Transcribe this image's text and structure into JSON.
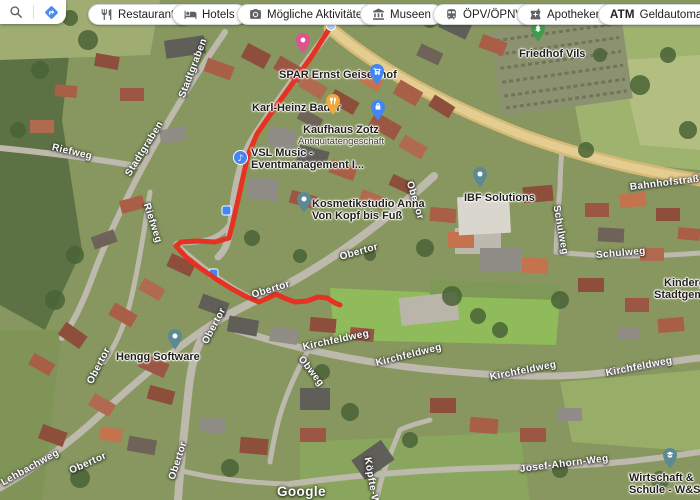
{
  "toolbar": {
    "buttons": [
      {
        "label": "Restaurants"
      },
      {
        "label": "Hotels"
      },
      {
        "label": "Mögliche Aktivitäten"
      },
      {
        "label": "Museen"
      },
      {
        "label": "ÖPV/ÖPNV"
      },
      {
        "label": "Apotheken"
      },
      {
        "label": "Geldautomaten"
      }
    ],
    "atm_icon_text": "ATM"
  },
  "map": {
    "watermark": "Google",
    "route": {
      "color": "#e63222",
      "start_dot_color": "#a6d3f2",
      "points": [
        [
          331,
          26
        ],
        [
          312,
          56
        ],
        [
          292,
          84
        ],
        [
          272,
          112
        ],
        [
          257,
          134
        ],
        [
          248,
          155
        ],
        [
          243,
          177
        ],
        [
          238,
          200
        ],
        [
          233,
          222
        ],
        [
          229,
          238
        ],
        [
          215,
          242
        ],
        [
          197,
          241
        ],
        [
          181,
          242
        ],
        [
          176,
          246
        ],
        [
          186,
          257
        ],
        [
          200,
          268
        ],
        [
          216,
          279
        ],
        [
          232,
          289
        ],
        [
          247,
          297
        ],
        [
          259,
          302
        ],
        [
          268,
          298
        ],
        [
          276,
          294
        ],
        [
          284,
          298
        ],
        [
          295,
          302
        ],
        [
          307,
          301
        ],
        [
          318,
          297
        ],
        [
          327,
          298
        ],
        [
          335,
          303
        ],
        [
          340,
          305
        ]
      ]
    },
    "streets": {
      "riefweg": "Riefweg",
      "stadtgraben": "Stadtgraben",
      "obertor": "Obertor",
      "bahnhofstrasse": "Bahnhofstraße",
      "schulweg": "Schulweg",
      "kirchfeldweg": "Kirchfeldweg",
      "obweg": "Obweg",
      "lehbachweg": "Lehbachweg",
      "koepfte_weg": "Köpfte-Weg",
      "josef_ahorn_weg": "Josef-Ahorn-Weg"
    },
    "pois": {
      "spar": {
        "name": "SPAR Ernst Geisenhof",
        "pin_color": "#4285f4"
      },
      "bader": {
        "name": "Karl-Heinz Bader",
        "pin_color": "#f2a93b"
      },
      "kaufhaus": {
        "name": "Kaufhaus Zotz",
        "subtitle": "Antiquitätengeschäft",
        "pin_color": "#4285f4"
      },
      "vsl": {
        "line1": "VSL Music -",
        "line2": "Eventmanagement I...",
        "pin_color": "#4285f4",
        "glyph": "♪"
      },
      "kosmetik": {
        "line1": "Kosmetikstudio Anna",
        "line2": "Von Kopf bis Fuß",
        "pin_color": "#5d8a92"
      },
      "ibf": {
        "name": "IBF Solutions",
        "pin_color": "#5d8a92"
      },
      "hengg": {
        "name": "Hengg Software",
        "pin_color": "#5d8a92"
      },
      "friedhof": {
        "name": "Friedhof Vils",
        "pin_color": "#3f9b4f"
      },
      "kindergarten": {
        "line1": "Kindergarten",
        "line2": "Stadtgemeinde"
      },
      "schule": {
        "line1": "Wirtschaft &",
        "line2": "Schule - W&S",
        "pin_color": "#5d8a92"
      }
    }
  }
}
